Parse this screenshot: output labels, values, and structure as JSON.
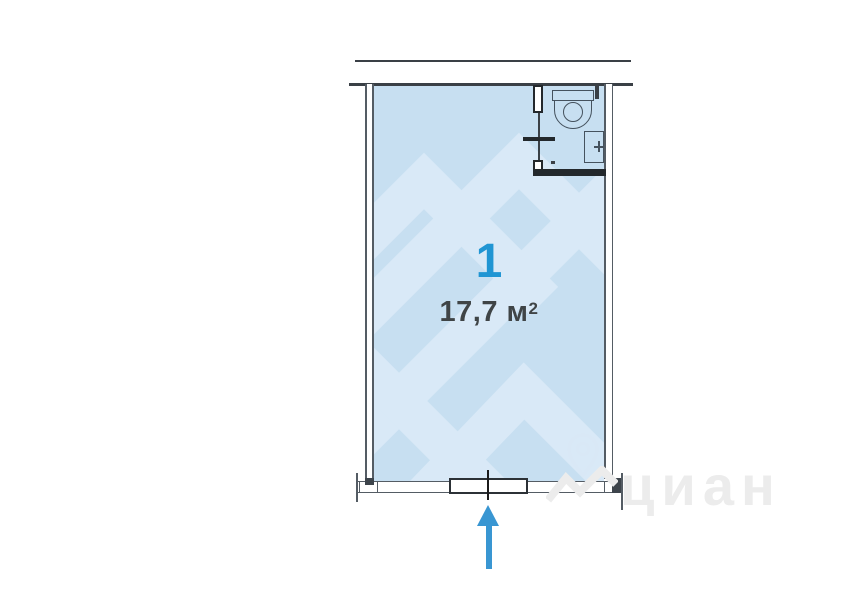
{
  "plan": {
    "room": {
      "number": "1",
      "area_text": "17,7 м",
      "area_sup": "2",
      "area_full": "17,7 м²"
    },
    "fixtures": [
      "toilet-icon",
      "sink-icon"
    ],
    "entrance": {
      "symbol": "arrow-up-icon"
    },
    "watermark": {
      "brand": "циан"
    },
    "colors": {
      "room_fill": "#c7dff1",
      "pattern_light": "#d9e9f7",
      "room_number_blue": "#2095d3",
      "arrow_blue": "#3996d2",
      "wall_dark": "#23282c",
      "wall_mid": "#3a4046",
      "line_gray": "#545c64",
      "area_text": "#3f4446",
      "watermark_gray": "#ececec"
    }
  }
}
